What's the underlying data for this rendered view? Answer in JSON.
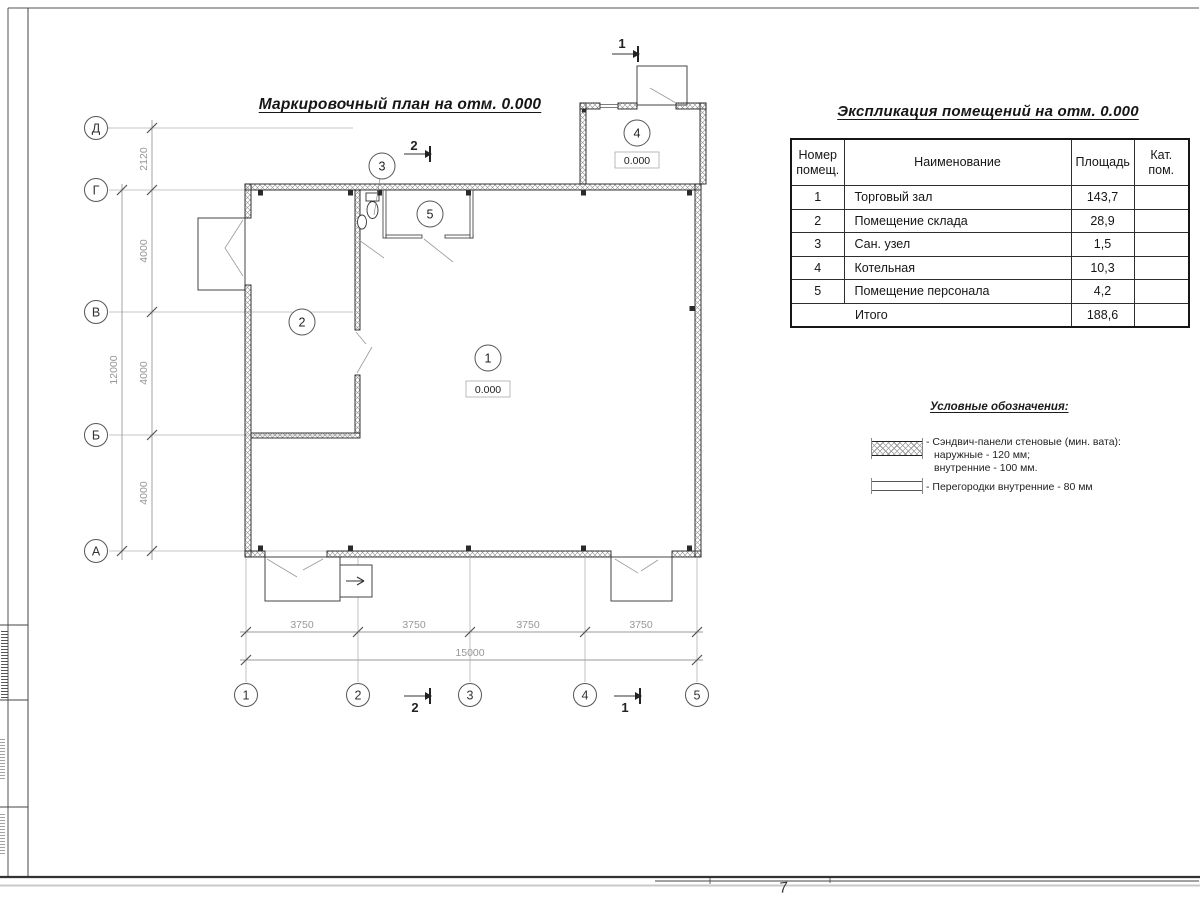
{
  "plan": {
    "title": "Маркировочный план на отм. 0.000",
    "grid_rows": [
      "Д",
      "Г",
      "В",
      "Б",
      "А"
    ],
    "grid_cols": [
      "1",
      "2",
      "3",
      "4",
      "5"
    ],
    "dims_vertical": [
      "2120",
      "4000",
      "4000",
      "4000"
    ],
    "dim_vertical_total": "12000",
    "dims_horizontal": [
      "3750",
      "3750",
      "3750",
      "3750"
    ],
    "dim_horizontal_total": "15000",
    "rooms": [
      {
        "num": "1",
        "elev": "0.000"
      },
      {
        "num": "2"
      },
      {
        "num": "3"
      },
      {
        "num": "4",
        "elev": "0.000"
      },
      {
        "num": "5"
      }
    ],
    "section_markers": [
      "1",
      "2"
    ],
    "sheet_note": "7"
  },
  "table": {
    "title": "Экспликация помещений на отм. 0.000",
    "headers": {
      "num": "Номер помещ.",
      "name": "Наименование",
      "area": "Площадь",
      "cat": "Кат. пом."
    },
    "rows": [
      {
        "num": "1",
        "name": "Торговый зал",
        "area": "143,7",
        "cat": ""
      },
      {
        "num": "2",
        "name": "Помещение склада",
        "area": "28,9",
        "cat": ""
      },
      {
        "num": "3",
        "name": "Сан. узел",
        "area": "1,5",
        "cat": ""
      },
      {
        "num": "4",
        "name": "Котельная",
        "area": "10,3",
        "cat": ""
      },
      {
        "num": "5",
        "name": "Помещение персонала",
        "area": "4,2",
        "cat": ""
      }
    ],
    "total_label": "Итого",
    "total_area": "188,6"
  },
  "legend": {
    "title": "Условные обозначения:",
    "items": [
      {
        "symbol": "sandwich-panel-hatch",
        "lines": [
          "- Сэндвич-панели стеновые (мин. вата):",
          "наружные - 120 мм;",
          "внутренние - 100 мм."
        ]
      },
      {
        "symbol": "internal-partition",
        "lines": [
          "- Перегородки внутренние - 80 мм"
        ]
      }
    ]
  },
  "colors": {
    "line": "#222222",
    "light_line": "#b0b0b0",
    "dim_text": "#979797"
  }
}
